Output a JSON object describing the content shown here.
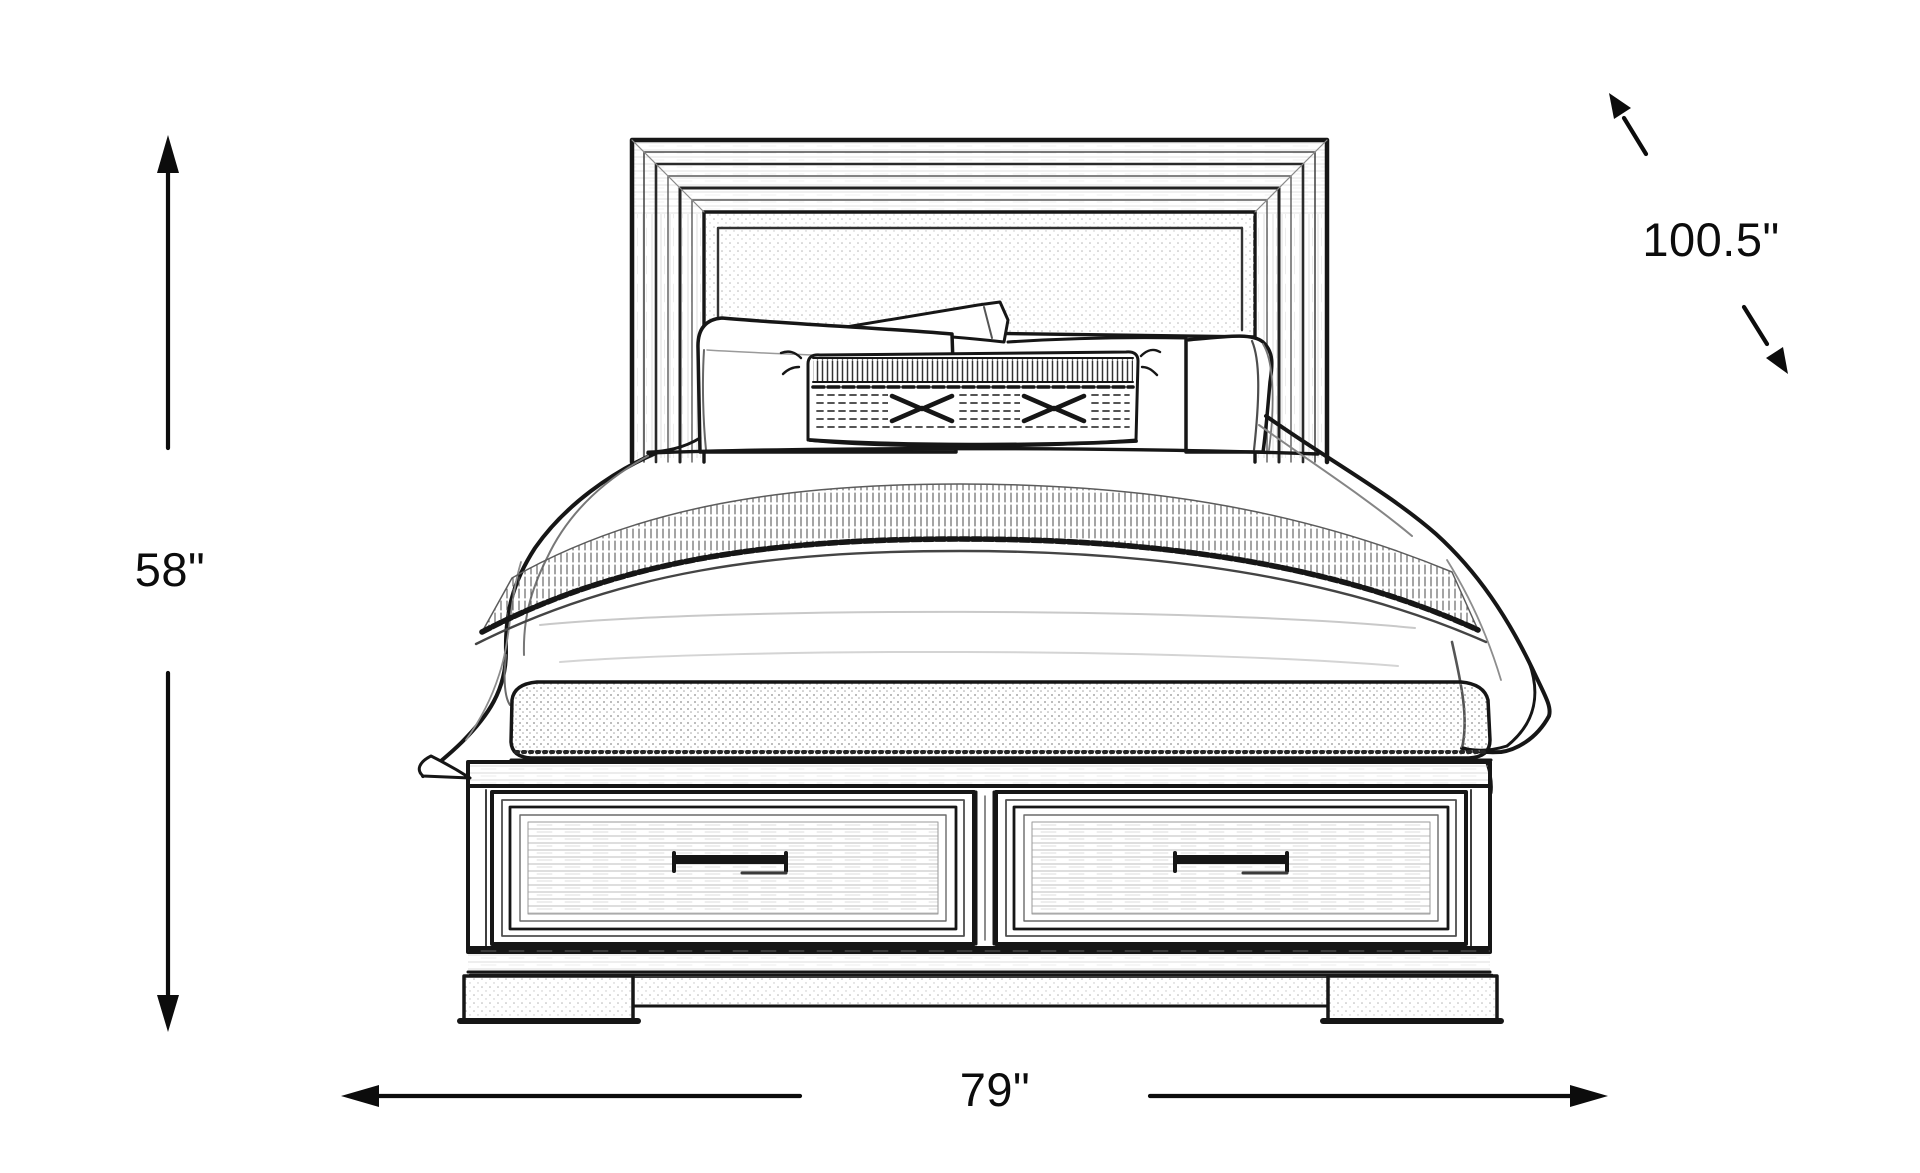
{
  "page": {
    "background_color": "#ffffff",
    "ink_color": "#161616"
  },
  "diagram": {
    "subject": "panel storage bed with bench footboard and two drawers",
    "style": "pencil-sketch dimension drawing",
    "dimensions": {
      "height": {
        "label": "58\"",
        "orientation": "vertical-left"
      },
      "width": {
        "label": "79\"",
        "orientation": "horizontal-bottom"
      },
      "depth": {
        "label": "100.5\"",
        "orientation": "diagonal-top-right"
      }
    }
  }
}
